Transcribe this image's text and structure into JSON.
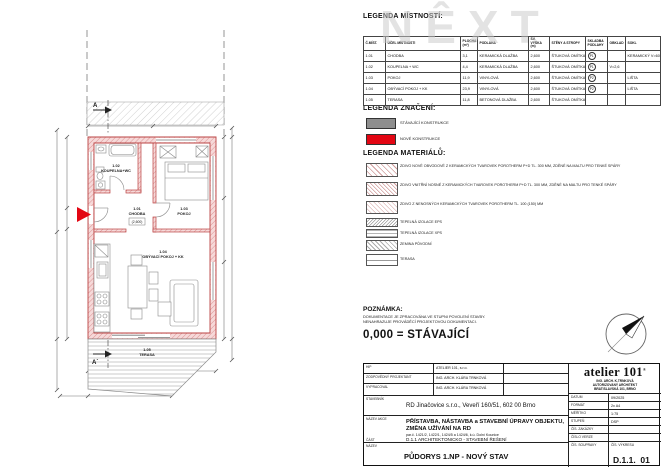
{
  "watermark": "NÊXT",
  "colors": {
    "new_construction_red": "#e30613",
    "existing_gray": "#8e8e8e",
    "wall_pink": "#f6d9d9"
  },
  "legend_rooms": {
    "title": "LEGENDA MÍSTNOSTÍ:",
    "headers": [
      "Č.MÍST.",
      "ÚČEL MÍSTNOSTI",
      "PLOCHA (m²)",
      "PODLAHA",
      "SV. VÝŠKA (m)",
      "STĚNY A STROPY",
      "SKLADBA PODLAHY",
      "OBKLAD",
      "SOKL"
    ],
    "rows": [
      {
        "num": "1.01",
        "name": "CHODBA",
        "area": "3,1",
        "floor": "KERAMICKÁ DLAŽBA",
        "height": "2,600",
        "walls": "ŠTUKOVÁ OMÍTKA",
        "layer": "P1",
        "tiling": "",
        "skirting": "KERAMICKÝ V=60MM"
      },
      {
        "num": "1.02",
        "name": "KOUPELNA + WC",
        "area": "4,4",
        "floor": "KERAMICKÁ DLAŽBA",
        "height": "2,600",
        "walls": "ŠTUKOVÁ OMÍTKA",
        "layer": "P1",
        "tiling": "V=2,6",
        "skirting": ""
      },
      {
        "num": "1.03",
        "name": "POKOJ",
        "area": "11,9",
        "floor": "VINYLOVÁ",
        "height": "2,600",
        "walls": "ŠTUKOVÁ OMÍTKA",
        "layer": "P2",
        "tiling": "",
        "skirting": "LIŠTA"
      },
      {
        "num": "1.04",
        "name": "OBÝVACÍ POKOJ + KK",
        "area": "23,9",
        "floor": "VINYLOVÁ",
        "height": "2,600",
        "walls": "ŠTUKOVÁ OMÍTKA",
        "layer": "P2",
        "tiling": "",
        "skirting": "LIŠTA"
      },
      {
        "num": "1.05",
        "name": "TERASA",
        "area": "11,8",
        "floor": "BETONOVÁ DLAŽBA",
        "height": "2,600",
        "walls": "ŠTUKOVÁ OMÍTKA",
        "layer": "",
        "tiling": "",
        "skirting": ""
      }
    ]
  },
  "legend_marks": {
    "title": "LEGENDA ZNAČENÍ:",
    "items": [
      {
        "label": "STÁVAJÍCÍ KONSTRUKCE",
        "color": "#8e8e8e"
      },
      {
        "label": "NOVÉ KONSTRUKCE",
        "color": "#e30613"
      }
    ]
  },
  "legend_materials": {
    "title": "LEGENDA MATERIÁLŮ:",
    "items": [
      {
        "label": "ZDIVO NOVÉ OBVODOVÉ Z KERAMICKÝCH TVAROVEK POROTHERM P+D TL. 300 MM, ZDĚNÉ NA MALTU PRO TENKÉ SPÁRY"
      },
      {
        "label": "ZDIVO VNITŘNÍ NOSNÉ Z KERAMICKÝCH TVAROVEK POROTHERM P+D TL. 300 MM, ZDĚNÉ NA MALTU PRO TENKÉ SPÁRY"
      },
      {
        "label": "ZDIVO Z NENOSNÝCH KERAMICKÝCH TVAROVEK POROTHERM TL. 100 (150) MM"
      },
      {
        "label": "TEPELNÁ IZOLACE EPS"
      },
      {
        "label": "TEPELNÁ IZOLACE XPS"
      },
      {
        "label": "ZEMINA PŮVODNÍ"
      },
      {
        "label": "TERASA"
      }
    ]
  },
  "note": {
    "title": "POZNÁMKA:",
    "line1": "DOKUMENTACE JE ZPRACOVÁNA VE STUPNI POVOLENÍ STAVBY.",
    "line2": "NENAHRAZUJE PROVÁDĚCÍ PROJEKTOVOU DOKUMENTACI.",
    "zero": "0,000 = STÁVAJÍCÍ"
  },
  "plan": {
    "rooms": [
      {
        "num": "1.02",
        "name": "KOUPELNA+WC"
      },
      {
        "num": "1.01",
        "name": "CHODBA",
        "sub": "(2,600)"
      },
      {
        "num": "1.03",
        "name": "POKOJ"
      },
      {
        "num": "1.04",
        "name": "OBÝVACÍ POKOJ + KK"
      },
      {
        "num": "1.05",
        "name": "TERASA"
      }
    ],
    "section_top": "A",
    "section_bottom": "A´"
  },
  "titleblock": {
    "hip_label": "HIP",
    "hip": "ATELIER 101, s.r.o.",
    "proj_label": "ZODPOVĚDNÝ PROJEKTANT",
    "proj": "ING. ARCH. KLÁRA TRNKOVÁ",
    "vypr_label": "VYPRACOVAL",
    "vypr": "ING. ARCH. KLÁRA TRNKOVÁ",
    "stavebnik_label": "STAVEBNÍK",
    "stavebnik": "RD Jinačovice s.r.o., Veveří 160/51, 602 00 Brno",
    "akce_label": "NÁZEV AKCE",
    "akce_line1": "PŘÍSTAVBA, NÁSTAVBA a STAVEBNÍ ÚPRAVY OBJEKTU,",
    "akce_line2": "ZMĚNA UŽÍVÁNÍ NA RD",
    "akce_sub": "par.č. 1421/2, 1422/1, 1424/5 a 1424/6, k.ú. Dolní Kounice",
    "cast_label": "ČÁST",
    "cast": "D.1.1 ARCHITEKTONICKO - STAVEBNÍ ŘEŠENÍ",
    "nazev_label": "NÁZEV",
    "nazev": "PŮDORYS 1.NP - NOVÝ STAV",
    "logo": {
      "name": "atelier 101",
      "reg": "®",
      "line1": "ING. ARCH. K.TRNKOVÁ",
      "line2": "AUTORIZOVANÝ ARCHITEKT",
      "line3": "BRATISLAVSKÁ 101, BRNO"
    },
    "meta": [
      {
        "label": "DATUM",
        "value": "09/2025"
      },
      {
        "label": "FORMÁT",
        "value": "2x A4"
      },
      {
        "label": "MĚŘÍTKO",
        "value": "1:75"
      },
      {
        "label": "STUPEŇ",
        "value": "DSP"
      },
      {
        "label": "ČÍS. ZAKÁZKY",
        "value": ""
      },
      {
        "label": "ČÍSLO VERZE",
        "value": ""
      }
    ],
    "souprava_label": "ČÍS. SOUPRAVY",
    "vykres_label": "ČÍS. VÝKRESU",
    "vykres_code": "D.1.1.",
    "vykres_num": "01"
  }
}
